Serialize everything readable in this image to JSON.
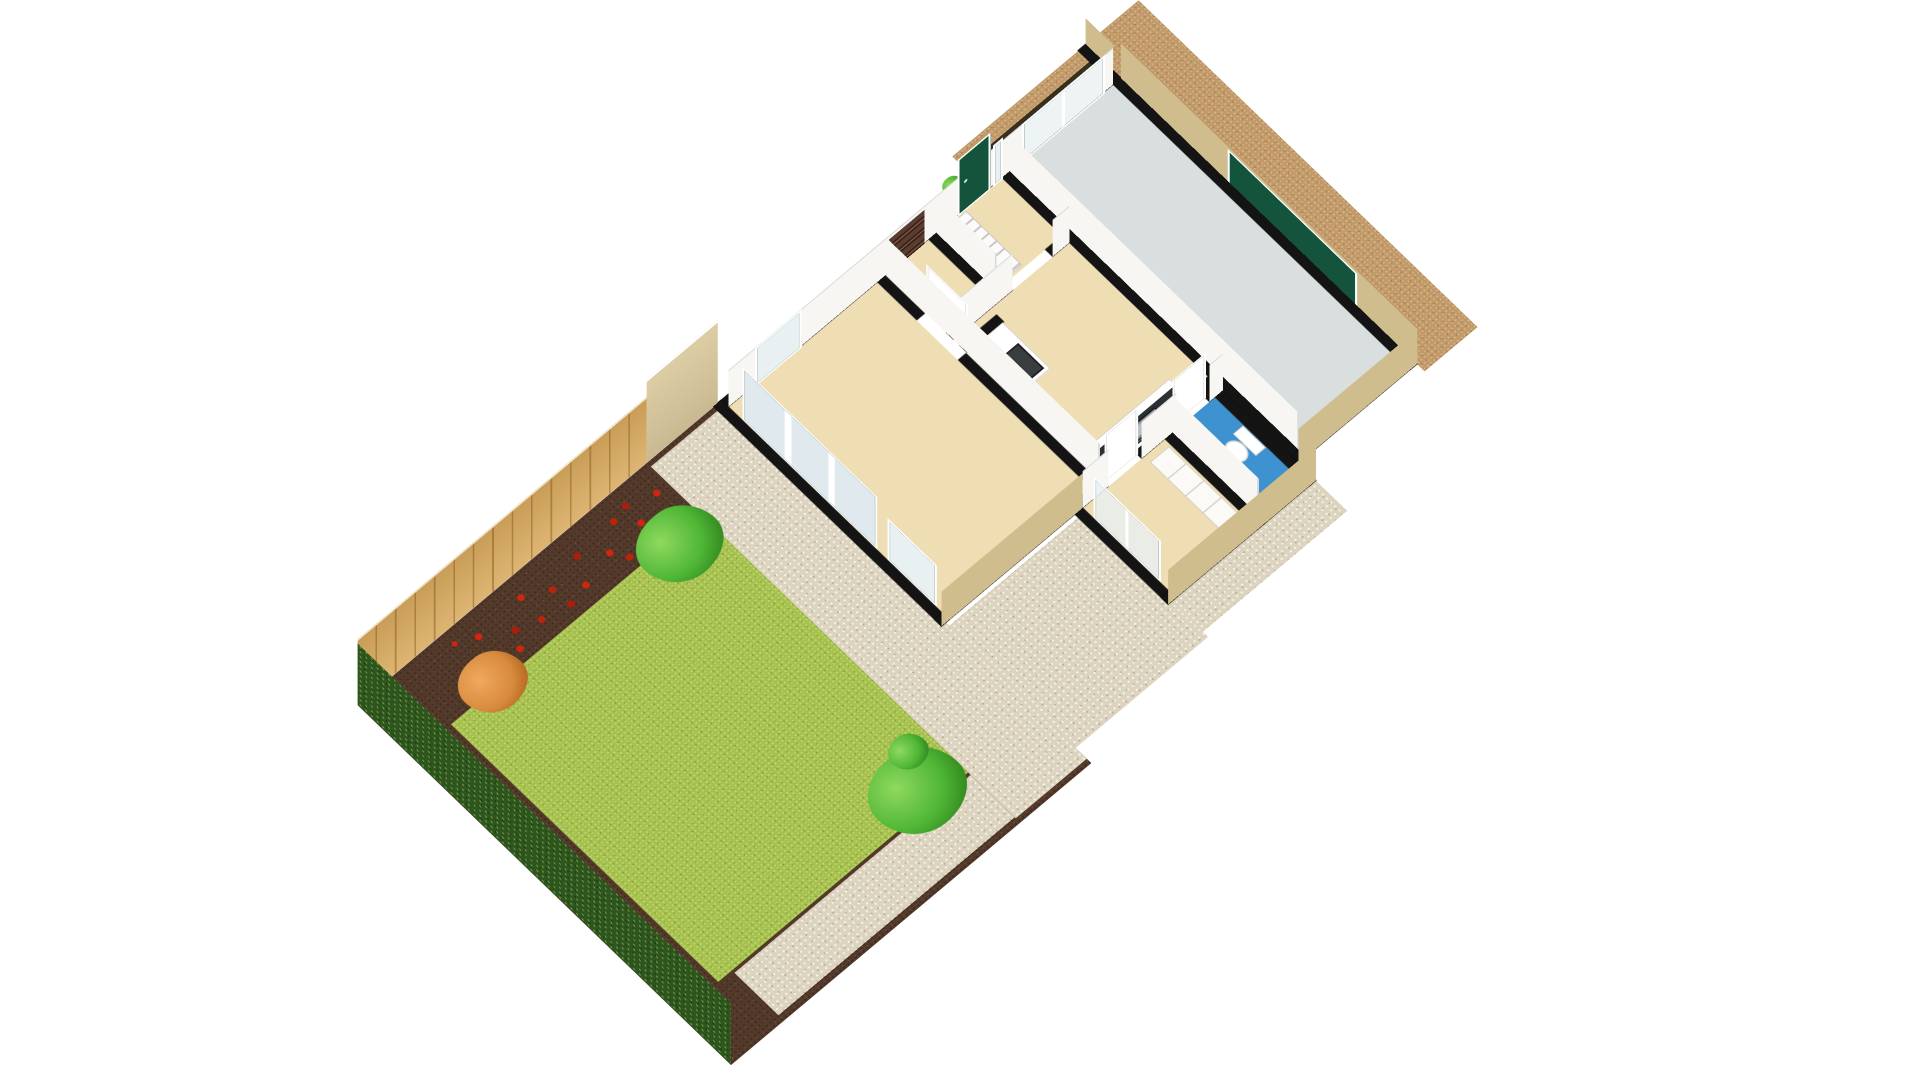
{
  "scene": {
    "background": "#ffffff",
    "projection": "isometric-cutaway-3d-floorplan",
    "subject": "Ground floor 3D doll's-house floor plan with rear garden, patio, garage and driveway",
    "visible_text": ""
  },
  "palette": {
    "wallCut": "#141414",
    "wallInner": "#f7f6f3",
    "wallExterior": "#d0bd8d",
    "gardenWall": "#d9c79b",
    "floorBeige": "#efddb3",
    "floorGarage": "#d9dede",
    "floorBath": "#3e92cf",
    "pebble": "#ddd4c0",
    "lawn": "#a6c14f",
    "soil": "#53392a",
    "hedge": "#2e551e",
    "fenceWood": "#d9ab5f",
    "driveway": "#c29a69",
    "frontSoil": "#37301f",
    "doorGreen": "#14543c",
    "glass": "#e8f0f2",
    "counterDark": "#2c3032",
    "applianceDark": "#3a3d40",
    "steel": "#b9bfc2",
    "white": "#ffffff",
    "treeGreen": "#4fb636",
    "treeAutumn": "#d78a3c",
    "flowerRed": "#d2240f"
  },
  "house": {
    "rooms": [
      {
        "id": "living-room",
        "floor": "beige carpet",
        "features": [
          "patio-french-doors",
          "window",
          "interior-door"
        ]
      },
      {
        "id": "kitchen",
        "floor": "beige carpet",
        "features": [
          "tall-oven-unit",
          "counter-with-sink"
        ]
      },
      {
        "id": "entrance-hall",
        "floor": "beige carpet",
        "features": [
          "green-front-door",
          "window",
          "staircase"
        ]
      },
      {
        "id": "storage-cupboard",
        "floor": "beige carpet",
        "features": [
          "shelving"
        ]
      },
      {
        "id": "bedroom",
        "floor": "beige carpet",
        "features": [
          "west-windows",
          "wardrobe",
          "white-door"
        ]
      },
      {
        "id": "bathroom",
        "floor": "blue vinyl",
        "features": [
          "toilet",
          "hand-basin"
        ]
      },
      {
        "id": "garage",
        "floor": "grey concrete",
        "features": [
          "green-garage-door",
          "front-window"
        ]
      }
    ]
  },
  "garden": {
    "features": [
      "lawn",
      "pebble-patio",
      "red-flower-bed",
      "autumn-shrub",
      "green-bush",
      "green-tree",
      "wooden-fence",
      "hedge",
      "tall-garden-wall",
      "driveway",
      "front-garden-bed",
      "potted-plant"
    ]
  }
}
